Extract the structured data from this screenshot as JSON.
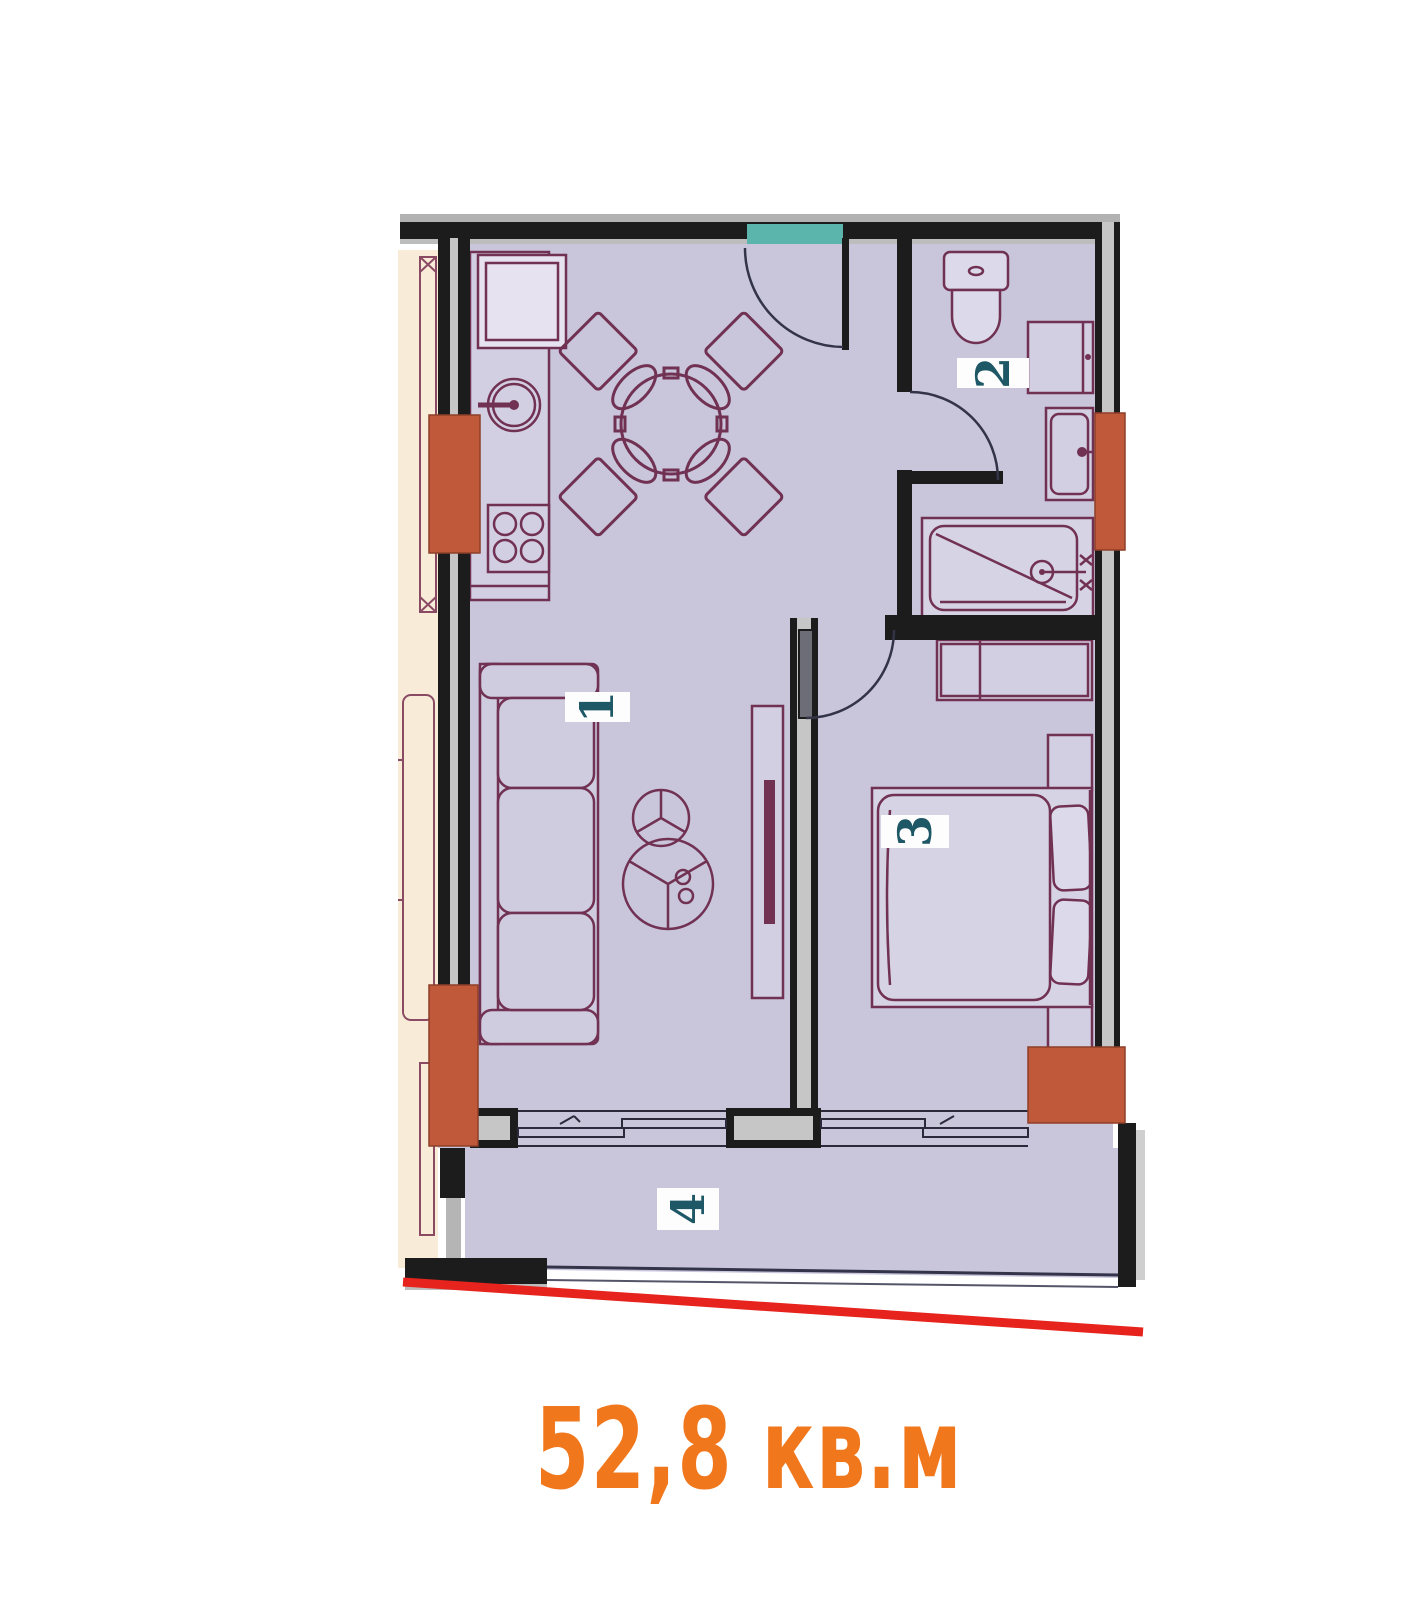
{
  "floor_plan": {
    "area_label": "52,8 кв.м",
    "rooms": [
      {
        "number": "1",
        "name": "living-room-kitchen"
      },
      {
        "number": "2",
        "name": "bathroom"
      },
      {
        "number": "3",
        "name": "bedroom"
      },
      {
        "number": "4",
        "name": "balcony"
      }
    ],
    "fixtures": [
      "fridge",
      "kitchen-sink",
      "stove",
      "dining-table-with-chairs",
      "sofa",
      "coffee-table",
      "tv-stand",
      "toilet",
      "washing-machine",
      "vanity-sink",
      "bathtub",
      "wardrobe",
      "double-bed",
      "nightstand",
      "entry-door",
      "bathroom-door",
      "bedroom-door",
      "balcony-windows",
      "red-boundary-line"
    ],
    "colors": {
      "floor": "#c9c6dc",
      "walls": "#1c1c1c",
      "wall_core": "#c6c6c6",
      "columns": "#c0593a",
      "entry_marker": "#5cb5ad",
      "furniture_line": "#713152",
      "neighbor_area": "#f8ecd8",
      "boundary_line": "#e6241d",
      "room_number_text": "#1e5766",
      "area_text": "#f1771d"
    }
  }
}
